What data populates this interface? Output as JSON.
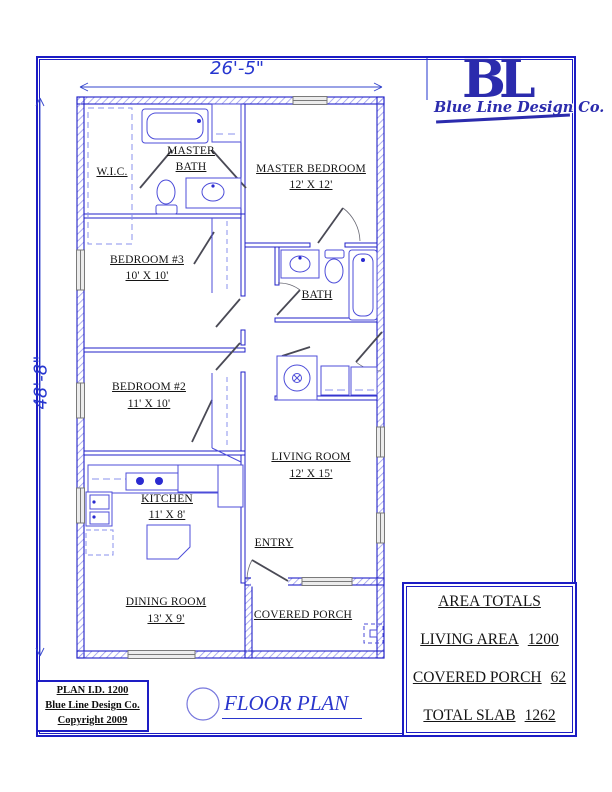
{
  "dimensions": {
    "top": "26'-5\"",
    "left": "48'-8\""
  },
  "logo": {
    "initials": "BL",
    "company_script": "Blue Line Design Co."
  },
  "rooms": {
    "wic": {
      "name": "W.I.C."
    },
    "master_bath": {
      "line1": "MASTER",
      "line2": "BATH"
    },
    "master_bedroom": {
      "name": "MASTER BEDROOM",
      "size": "12' X 12'"
    },
    "bedroom3": {
      "name": "BEDROOM #3",
      "size": "10' X 10'"
    },
    "bath": {
      "name": "BATH"
    },
    "bedroom2": {
      "name": "BEDROOM #2",
      "size": "11' X 10'"
    },
    "living_room": {
      "name": "LIVING ROOM",
      "size": "12' X 15'"
    },
    "kitchen": {
      "name": "KITCHEN",
      "size": "11' X 8'"
    },
    "entry": {
      "name": "ENTRY"
    },
    "dining_room": {
      "name": "DINING ROOM",
      "size": "13' X 9'"
    },
    "covered_porch": {
      "name": "COVERED PORCH"
    }
  },
  "title_block": {
    "plan_id": "PLAN I.D. 1200",
    "company": "Blue Line Design Co.",
    "copyright": "Copyright 2009"
  },
  "drawing_title": "FLOOR PLAN",
  "area_totals": {
    "title": "AREA TOTALS",
    "rows": [
      {
        "label": "LIVING AREA",
        "value": "1200"
      },
      {
        "label": "COVERED PORCH",
        "value": "62"
      },
      {
        "label": "TOTAL SLAB",
        "value": "1262"
      }
    ]
  },
  "colors": {
    "line_blue": "#2020c8",
    "fixture_blue": "#4d4dd9",
    "logo_blue": "#2b2bad"
  }
}
